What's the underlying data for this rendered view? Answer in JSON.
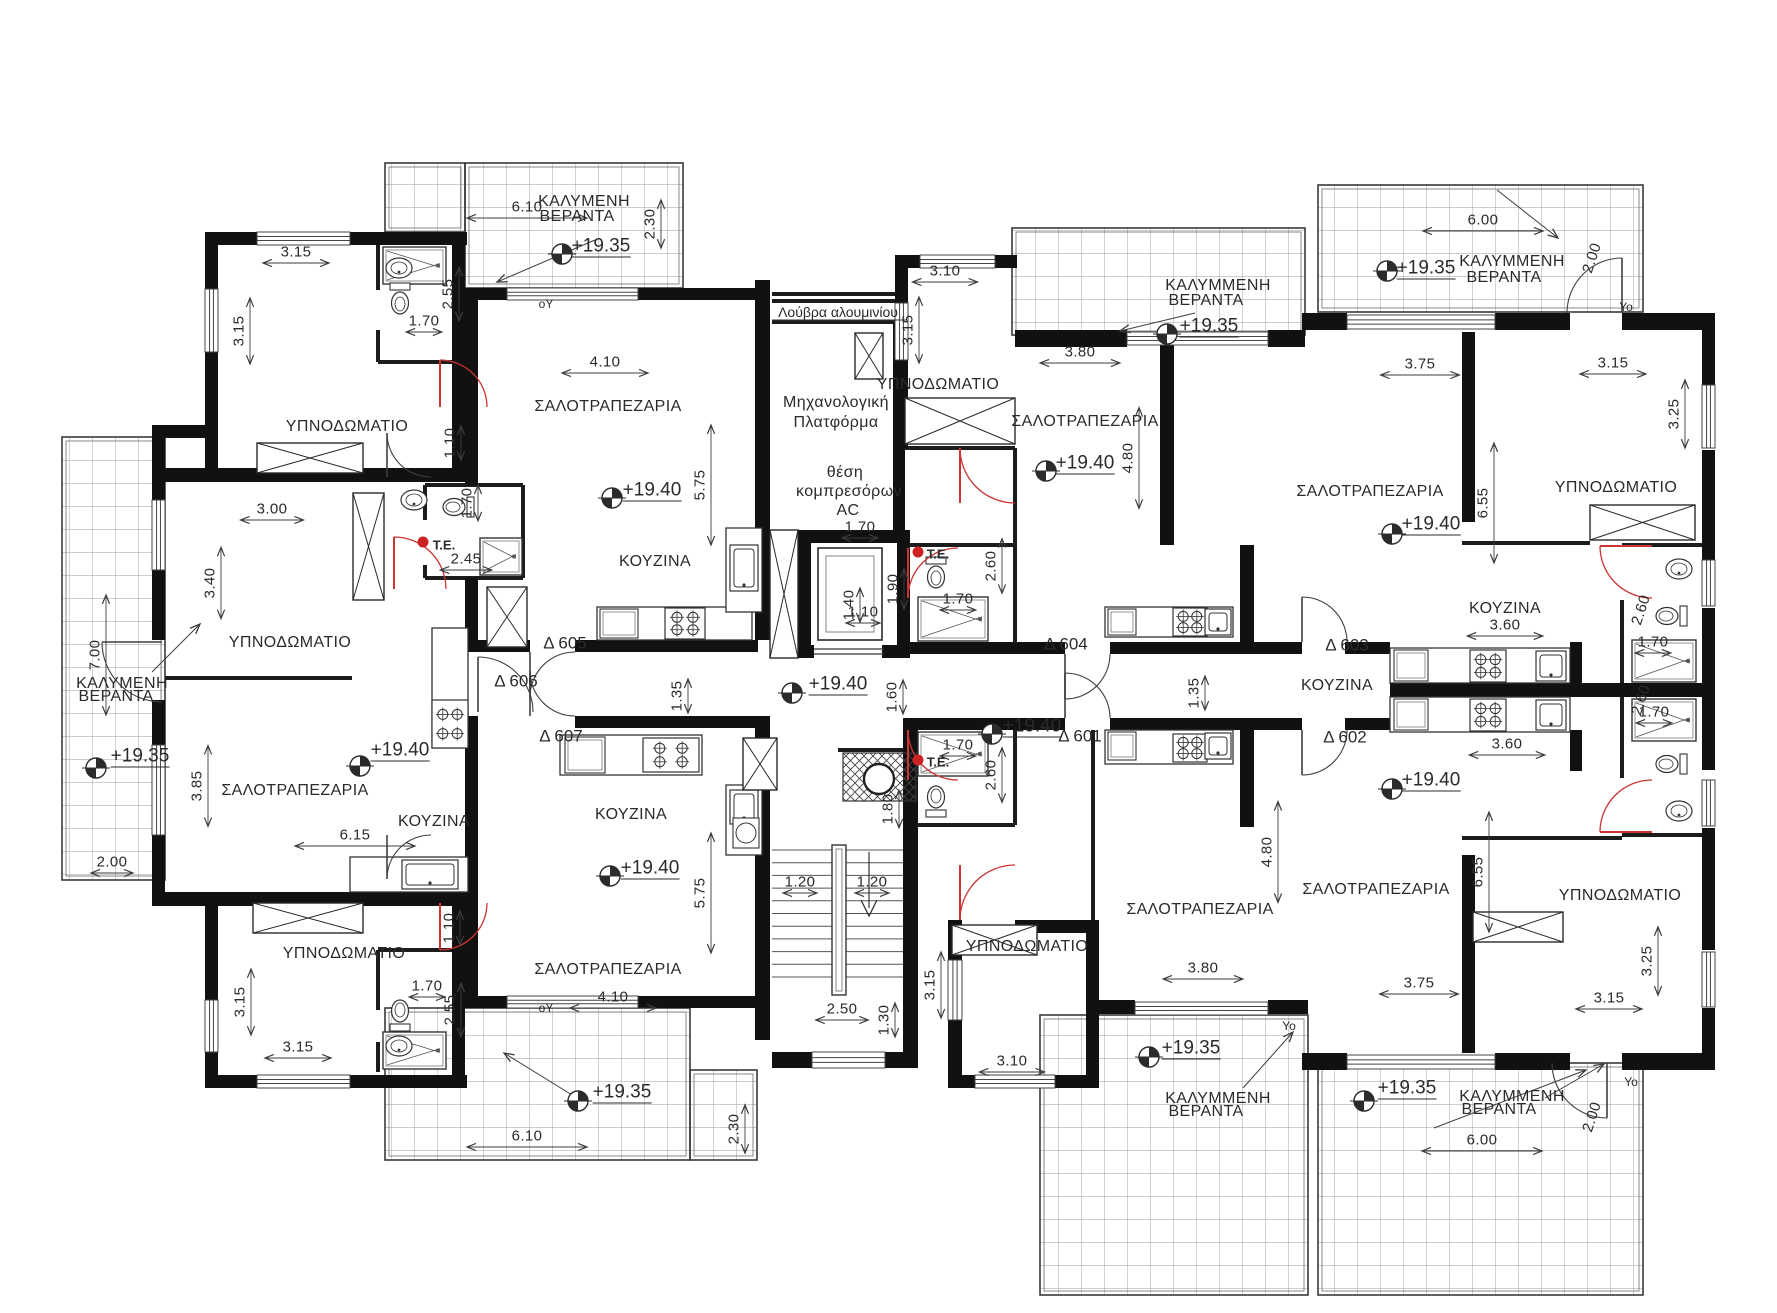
{
  "document": {
    "type": "architectural floor plan",
    "language": "Greek",
    "main_floor_level": "+19.40",
    "veranda_level": "+19.35"
  },
  "legend": {
    "bedroom": "ΥΠΝΟΔΩΜΑΤΙΟ",
    "living_dining": "ΣΑΛΟΤΡΑΠΕΖΑΡΙΑ",
    "kitchen": "ΚΟΥΖΙΝΑ",
    "covered_veranda": "ΚΑΛΥΜΜΕΝΗ ΒΕΡΑΝΤΑ",
    "covered_veranda_alt_spelling": "ΚΑΛΥΜΕΝΗ ΒΕΡΑΝΤΑ",
    "aluminium_louvre": "Λούβρα αλουμινίου",
    "mechanical_platform": "Μηχανολογική Πλατφόρμα",
    "ac_compressor_position": "θέση κομπρεσόρων AC",
    "te_marker": "Τ.Ε."
  },
  "apartments": [
    "Δ 601",
    "Δ 602",
    "Δ 603",
    "Δ 604",
    "Δ 605",
    "Δ 606",
    "Δ 607"
  ],
  "plan_labels": [
    {
      "t": "3.15",
      "x": 296,
      "y": 252,
      "r": 0,
      "k": "dim"
    },
    {
      "t": "3.15",
      "x": 239,
      "y": 331,
      "r": -90,
      "k": "dim"
    },
    {
      "t": "1.70",
      "x": 424,
      "y": 321,
      "r": 0,
      "k": "dim"
    },
    {
      "t": "2.55",
      "x": 448,
      "y": 294,
      "r": -90,
      "k": "dim"
    },
    {
      "t": "ΥΠΝΟΔΩΜΑΤΙΟ",
      "x": 347,
      "y": 427,
      "r": 0,
      "k": "room"
    },
    {
      "t": "1.10",
      "x": 450,
      "y": 443,
      "r": -90,
      "k": "dim"
    },
    {
      "t": "6.10",
      "x": 527,
      "y": 207,
      "r": 0,
      "k": "dim"
    },
    {
      "t": "ΚΑΛΥΜΕΝΗ",
      "x": 584,
      "y": 202,
      "r": 0,
      "k": "room"
    },
    {
      "t": "ΒΕΡΑΝΤΑ",
      "x": 577,
      "y": 217,
      "r": 0,
      "k": "room"
    },
    {
      "t": "+19.35",
      "x": 601,
      "y": 247,
      "r": 0,
      "k": "level"
    },
    {
      "t": "2.30",
      "x": 650,
      "y": 224,
      "r": -90,
      "k": "dim"
    },
    {
      "t": "οΥ",
      "x": 546,
      "y": 304,
      "r": 0,
      "k": "marker"
    },
    {
      "t": "4.10",
      "x": 605,
      "y": 362,
      "r": 0,
      "k": "dim"
    },
    {
      "t": "ΣΑΛΟΤΡΑΠΕΖΑΡΙΑ",
      "x": 608,
      "y": 407,
      "r": 0,
      "k": "room"
    },
    {
      "t": "+19.40",
      "x": 652,
      "y": 491,
      "r": 0,
      "k": "level"
    },
    {
      "t": "5.75",
      "x": 700,
      "y": 485,
      "r": -90,
      "k": "dim"
    },
    {
      "t": "ΚΟΥΖΙΝΑ",
      "x": 655,
      "y": 562,
      "r": 0,
      "k": "room"
    },
    {
      "t": "Δ 605",
      "x": 565,
      "y": 643,
      "r": 0,
      "k": "apt"
    },
    {
      "t": "3.00",
      "x": 272,
      "y": 509,
      "r": 0,
      "k": "dim"
    },
    {
      "t": "3.40",
      "x": 210,
      "y": 583,
      "r": -90,
      "k": "dim"
    },
    {
      "t": "1.70",
      "x": 467,
      "y": 503,
      "r": -90,
      "k": "dim"
    },
    {
      "t": "Τ.Ε.",
      "x": 444,
      "y": 545,
      "r": 0,
      "k": "te"
    },
    {
      "t": "2.45",
      "x": 466,
      "y": 559,
      "r": 0,
      "k": "dim"
    },
    {
      "t": "ΥΠΝΟΔΩΜΑΤΙΟ",
      "x": 290,
      "y": 643,
      "r": 0,
      "k": "room"
    },
    {
      "t": "Δ 606",
      "x": 516,
      "y": 681,
      "r": 0,
      "k": "apt"
    },
    {
      "t": "7.00",
      "x": 95,
      "y": 655,
      "r": -90,
      "k": "dim"
    },
    {
      "t": "ΚΑΛΥΜΕΝΗ",
      "x": 122,
      "y": 684,
      "r": 0,
      "k": "room"
    },
    {
      "t": "ΒΕΡΑΝΤΑ",
      "x": 116,
      "y": 697,
      "r": 0,
      "k": "room"
    },
    {
      "t": "+19.35",
      "x": 140,
      "y": 757,
      "r": 0,
      "k": "level"
    },
    {
      "t": "2.00",
      "x": 112,
      "y": 862,
      "r": 0,
      "k": "dim"
    },
    {
      "t": "3.85",
      "x": 197,
      "y": 786,
      "r": -90,
      "k": "dim"
    },
    {
      "t": "ΣΑΛΟΤΡΑΠΕΖΑΡΙΑ",
      "x": 295,
      "y": 791,
      "r": 0,
      "k": "room"
    },
    {
      "t": "+19.40",
      "x": 400,
      "y": 751,
      "r": 0,
      "k": "level"
    },
    {
      "t": "6.15",
      "x": 355,
      "y": 835,
      "r": 0,
      "k": "dim"
    },
    {
      "t": "ΚΟΥΖΙΝΑ",
      "x": 434,
      "y": 822,
      "r": 0,
      "k": "room"
    },
    {
      "t": "ΥΠΝΟΔΩΜΑΤΙΟ",
      "x": 344,
      "y": 954,
      "r": 0,
      "k": "room"
    },
    {
      "t": "1.10",
      "x": 449,
      "y": 928,
      "r": -90,
      "k": "dim"
    },
    {
      "t": "1.70",
      "x": 427,
      "y": 986,
      "r": 0,
      "k": "dim"
    },
    {
      "t": "2.55",
      "x": 450,
      "y": 1010,
      "r": -90,
      "k": "dim"
    },
    {
      "t": "3.15",
      "x": 240,
      "y": 1002,
      "r": -90,
      "k": "dim"
    },
    {
      "t": "3.15",
      "x": 298,
      "y": 1047,
      "r": 0,
      "k": "dim"
    },
    {
      "t": "οΥ",
      "x": 546,
      "y": 1008,
      "r": 0,
      "k": "marker"
    },
    {
      "t": "Δ 607",
      "x": 561,
      "y": 736,
      "r": 0,
      "k": "apt"
    },
    {
      "t": "ΚΟΥΖΙΝΑ",
      "x": 631,
      "y": 815,
      "r": 0,
      "k": "room"
    },
    {
      "t": "+19.40",
      "x": 650,
      "y": 869,
      "r": 0,
      "k": "level"
    },
    {
      "t": "5.75",
      "x": 700,
      "y": 893,
      "r": -90,
      "k": "dim"
    },
    {
      "t": "ΣΑΛΟΤΡΑΠΕΖΑΡΙΑ",
      "x": 608,
      "y": 970,
      "r": 0,
      "k": "room"
    },
    {
      "t": "4.10",
      "x": 613,
      "y": 997,
      "r": 0,
      "k": "dim"
    },
    {
      "t": "+19.35",
      "x": 622,
      "y": 1093,
      "r": 0,
      "k": "level"
    },
    {
      "t": "6.10",
      "x": 527,
      "y": 1136,
      "r": 0,
      "k": "dim"
    },
    {
      "t": "2.30",
      "x": 734,
      "y": 1129,
      "r": -90,
      "k": "dim"
    },
    {
      "t": "Λούβρα αλουμινίου",
      "x": 838,
      "y": 312,
      "r": 0,
      "k": "note"
    },
    {
      "t": "Μηχανολογική",
      "x": 836,
      "y": 403,
      "r": 0,
      "k": "room"
    },
    {
      "t": "Πλατφόρμα",
      "x": 836,
      "y": 423,
      "r": 0,
      "k": "room"
    },
    {
      "t": "θέση",
      "x": 845,
      "y": 473,
      "r": 0,
      "k": "room"
    },
    {
      "t": "κομπρεσόρων",
      "x": 849,
      "y": 492,
      "r": 0,
      "k": "room"
    },
    {
      "t": "AC",
      "x": 848,
      "y": 511,
      "r": 0,
      "k": "room"
    },
    {
      "t": "1.70",
      "x": 860,
      "y": 527,
      "r": 0,
      "k": "dim"
    },
    {
      "t": "1.40",
      "x": 849,
      "y": 605,
      "r": -90,
      "k": "dim"
    },
    {
      "t": "1.10",
      "x": 863,
      "y": 612,
      "r": 0,
      "k": "dim"
    },
    {
      "t": "1.90",
      "x": 893,
      "y": 589,
      "r": -90,
      "k": "dim"
    },
    {
      "t": "+19.40",
      "x": 838,
      "y": 685,
      "r": 0,
      "k": "level"
    },
    {
      "t": "1.35",
      "x": 677,
      "y": 696,
      "r": -90,
      "k": "dim"
    },
    {
      "t": "1.60",
      "x": 892,
      "y": 697,
      "r": -90,
      "k": "dim"
    },
    {
      "t": "1.35",
      "x": 1194,
      "y": 693,
      "r": -90,
      "k": "dim"
    },
    {
      "t": "1.80",
      "x": 888,
      "y": 809,
      "r": -90,
      "k": "dim"
    },
    {
      "t": "1.20",
      "x": 800,
      "y": 882,
      "r": 0,
      "k": "dim"
    },
    {
      "t": "1.20",
      "x": 872,
      "y": 882,
      "r": 0,
      "k": "dim"
    },
    {
      "t": "2.50",
      "x": 842,
      "y": 1009,
      "r": 0,
      "k": "dim"
    },
    {
      "t": "1.30",
      "x": 884,
      "y": 1020,
      "r": -90,
      "k": "dim"
    },
    {
      "t": "3.10",
      "x": 945,
      "y": 271,
      "r": 0,
      "k": "dim"
    },
    {
      "t": "3.15",
      "x": 908,
      "y": 330,
      "r": -90,
      "k": "dim"
    },
    {
      "t": "ΥΠΝΟΔΩΜΑΤΙΟ",
      "x": 938,
      "y": 385,
      "r": 0,
      "k": "room"
    },
    {
      "t": "Τ.Ε.",
      "x": 938,
      "y": 554,
      "r": 0,
      "k": "te"
    },
    {
      "t": "2.60",
      "x": 991,
      "y": 566,
      "r": -90,
      "k": "dim"
    },
    {
      "t": "1.70",
      "x": 958,
      "y": 599,
      "r": 0,
      "k": "dim"
    },
    {
      "t": "Δ 604",
      "x": 1066,
      "y": 644,
      "r": 0,
      "k": "apt"
    },
    {
      "t": "3.80",
      "x": 1080,
      "y": 352,
      "r": 0,
      "k": "dim"
    },
    {
      "t": "ΣΑΛΟΤΡΑΠΕΖΑΡΙΑ",
      "x": 1085,
      "y": 422,
      "r": 0,
      "k": "room"
    },
    {
      "t": "+19.40",
      "x": 1085,
      "y": 464,
      "r": 0,
      "k": "level"
    },
    {
      "t": "4.80",
      "x": 1128,
      "y": 458,
      "r": -90,
      "k": "dim"
    },
    {
      "t": "ΚΑΛΥΜΜΕΝΗ",
      "x": 1218,
      "y": 286,
      "r": 0,
      "k": "room"
    },
    {
      "t": "ΒΕΡΑΝΤΑ",
      "x": 1206,
      "y": 301,
      "r": 0,
      "k": "room"
    },
    {
      "t": "+19.35",
      "x": 1209,
      "y": 327,
      "r": 0,
      "k": "level"
    },
    {
      "t": "6.00",
      "x": 1483,
      "y": 220,
      "r": 0,
      "k": "dim"
    },
    {
      "t": "+19.35",
      "x": 1426,
      "y": 269,
      "r": 0,
      "k": "level"
    },
    {
      "t": "ΚΑΛΥΜΜΕΝΗ",
      "x": 1512,
      "y": 262,
      "r": 0,
      "k": "room"
    },
    {
      "t": "ΒΕΡΑΝΤΑ",
      "x": 1504,
      "y": 278,
      "r": 0,
      "k": "room"
    },
    {
      "t": "2.00",
      "x": 1592,
      "y": 258,
      "r": -72,
      "k": "dim"
    },
    {
      "t": "Υο",
      "x": 1626,
      "y": 307,
      "r": 0,
      "k": "marker"
    },
    {
      "t": "3.75",
      "x": 1420,
      "y": 364,
      "r": 0,
      "k": "dim"
    },
    {
      "t": "3.15",
      "x": 1613,
      "y": 363,
      "r": 0,
      "k": "dim"
    },
    {
      "t": "3.25",
      "x": 1674,
      "y": 414,
      "r": -90,
      "k": "dim"
    },
    {
      "t": "ΥΠΝΟΔΩΜΑΤΙΟ",
      "x": 1616,
      "y": 488,
      "r": 0,
      "k": "room"
    },
    {
      "t": "ΣΑΛΟΤΡΑΠΕΖΑΡΙΑ",
      "x": 1370,
      "y": 492,
      "r": 0,
      "k": "room"
    },
    {
      "t": "+19.40",
      "x": 1431,
      "y": 525,
      "r": 0,
      "k": "level"
    },
    {
      "t": "6.55",
      "x": 1483,
      "y": 503,
      "r": -90,
      "k": "dim"
    },
    {
      "t": "ΚΟΥΖΙΝΑ",
      "x": 1505,
      "y": 609,
      "r": 0,
      "k": "room"
    },
    {
      "t": "3.60",
      "x": 1505,
      "y": 625,
      "r": 0,
      "k": "dim"
    },
    {
      "t": "Δ 603",
      "x": 1347,
      "y": 645,
      "r": 0,
      "k": "apt"
    },
    {
      "t": "2.60",
      "x": 1641,
      "y": 610,
      "r": -72,
      "k": "dim"
    },
    {
      "t": "1.70",
      "x": 1653,
      "y": 642,
      "r": 0,
      "k": "dim"
    },
    {
      "t": "1.70",
      "x": 1654,
      "y": 712,
      "r": 0,
      "k": "dim"
    },
    {
      "t": "2.60",
      "x": 1641,
      "y": 700,
      "r": -72,
      "k": "dim"
    },
    {
      "t": "ΚΟΥΖΙΝΑ",
      "x": 1337,
      "y": 686,
      "r": 0,
      "k": "room"
    },
    {
      "t": "3.60",
      "x": 1507,
      "y": 744,
      "r": 0,
      "k": "dim"
    },
    {
      "t": "Δ 602",
      "x": 1345,
      "y": 737,
      "r": 0,
      "k": "apt"
    },
    {
      "t": "Τ.Ε.",
      "x": 938,
      "y": 762,
      "r": 0,
      "k": "te"
    },
    {
      "t": "2.60",
      "x": 991,
      "y": 775,
      "r": -90,
      "k": "dim"
    },
    {
      "t": "1.70",
      "x": 958,
      "y": 745,
      "r": 0,
      "k": "dim"
    },
    {
      "t": "Δ 601",
      "x": 1080,
      "y": 736,
      "r": 0,
      "k": "apt"
    },
    {
      "t": "+19.40",
      "x": 1032,
      "y": 727,
      "r": 0,
      "k": "level"
    },
    {
      "t": "ΥΠΝΟΔΩΜΑΤΙΟ",
      "x": 1027,
      "y": 947,
      "r": 0,
      "k": "room"
    },
    {
      "t": "3.10",
      "x": 1012,
      "y": 1061,
      "r": 0,
      "k": "dim"
    },
    {
      "t": "3.15",
      "x": 930,
      "y": 985,
      "r": -90,
      "k": "dim"
    },
    {
      "t": "ΣΑΛΟΤΡΑΠΕΖΑΡΙΑ",
      "x": 1200,
      "y": 910,
      "r": 0,
      "k": "room"
    },
    {
      "t": "3.80",
      "x": 1203,
      "y": 968,
      "r": 0,
      "k": "dim"
    },
    {
      "t": "4.80",
      "x": 1267,
      "y": 852,
      "r": -90,
      "k": "dim"
    },
    {
      "t": "+19.35",
      "x": 1191,
      "y": 1049,
      "r": 0,
      "k": "level"
    },
    {
      "t": "ΚΑΛΥΜΜΕΝΗ",
      "x": 1218,
      "y": 1099,
      "r": 0,
      "k": "room"
    },
    {
      "t": "ΒΕΡΑΝΤΑ",
      "x": 1206,
      "y": 1112,
      "r": 0,
      "k": "room"
    },
    {
      "t": "Υο",
      "x": 1289,
      "y": 1026,
      "r": 0,
      "k": "marker"
    },
    {
      "t": "+19.35",
      "x": 1407,
      "y": 1089,
      "r": 0,
      "k": "level"
    },
    {
      "t": "ΚΑΛΥΜΜΕΝΗ",
      "x": 1512,
      "y": 1097,
      "r": 0,
      "k": "room"
    },
    {
      "t": "ΒΕΡΑΝΤΑ",
      "x": 1499,
      "y": 1110,
      "r": 0,
      "k": "room"
    },
    {
      "t": "6.00",
      "x": 1482,
      "y": 1140,
      "r": 0,
      "k": "dim"
    },
    {
      "t": "2.00",
      "x": 1592,
      "y": 1117,
      "r": -72,
      "k": "dim"
    },
    {
      "t": "Υο",
      "x": 1631,
      "y": 1082,
      "r": 0,
      "k": "marker"
    },
    {
      "t": "3.75",
      "x": 1419,
      "y": 983,
      "r": 0,
      "k": "dim"
    },
    {
      "t": "3.15",
      "x": 1609,
      "y": 998,
      "r": 0,
      "k": "dim"
    },
    {
      "t": "3.25",
      "x": 1647,
      "y": 961,
      "r": -90,
      "k": "dim"
    },
    {
      "t": "ΥΠΝΟΔΩΜΑΤΙΟ",
      "x": 1620,
      "y": 896,
      "r": 0,
      "k": "room"
    },
    {
      "t": "ΣΑΛΟΤΡΑΠΕΖΑΡΙΑ",
      "x": 1376,
      "y": 890,
      "r": 0,
      "k": "room"
    },
    {
      "t": "+19.40",
      "x": 1431,
      "y": 781,
      "r": 0,
      "k": "level"
    },
    {
      "t": "6.55",
      "x": 1478,
      "y": 872,
      "r": -90,
      "k": "dim"
    }
  ]
}
